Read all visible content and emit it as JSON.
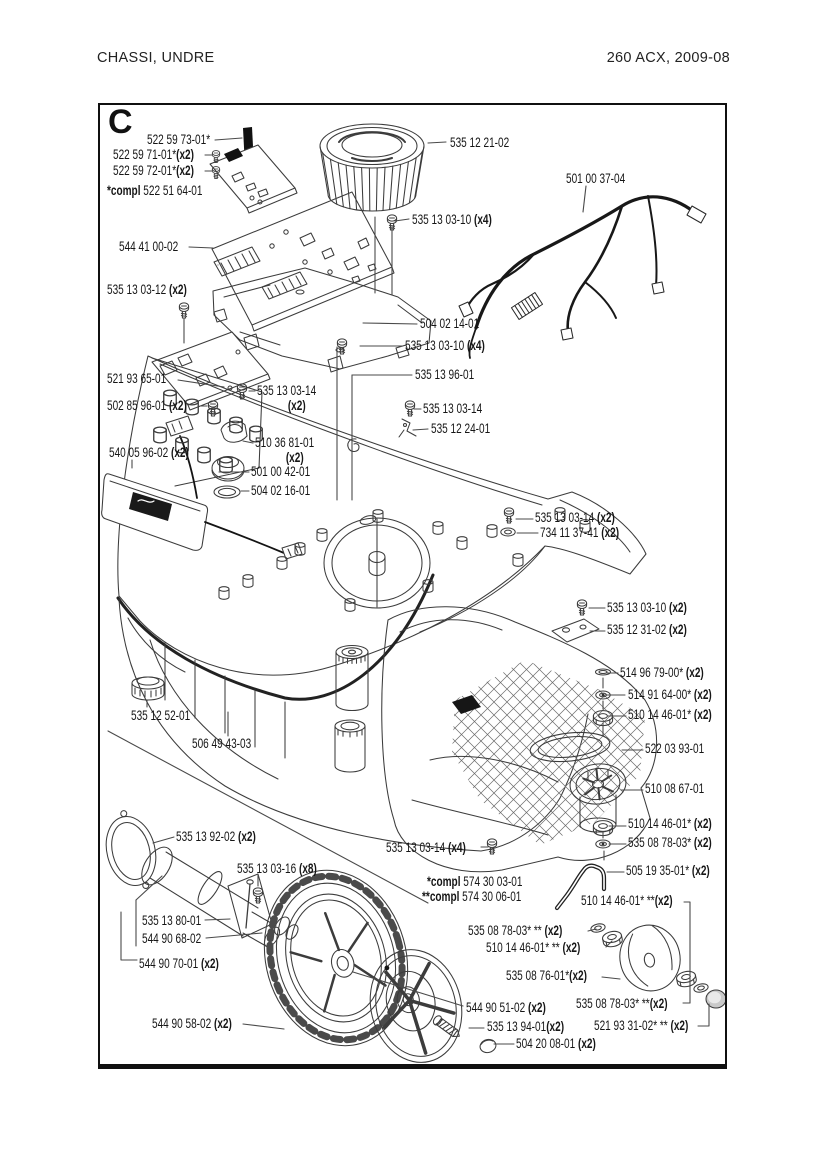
{
  "page": {
    "header_left": "CHASSI,  UNDRE",
    "header_right": "260 ACX, 2009-08",
    "section_letter": "C"
  },
  "diagram": {
    "labels": [
      {
        "num": "522 59 73-01*",
        "x": 147,
        "y": 133
      },
      {
        "num": "522 59 71-01*",
        "qty": "(x2)",
        "x": 113,
        "y": 148
      },
      {
        "num": "522 59 72-01*",
        "qty": "(x2)",
        "x": 113,
        "y": 164
      },
      {
        "pre": "*compl ",
        "num": "522 51 64-01",
        "x": 107,
        "y": 184
      },
      {
        "num": "544 41 00-02",
        "x": 119,
        "y": 240
      },
      {
        "num": "535 12 21-02",
        "x": 450,
        "y": 136
      },
      {
        "num": "501 00 37-04",
        "x": 566,
        "y": 172
      },
      {
        "num": "535 13 03-10 ",
        "qty": "(x4)",
        "x": 412,
        "y": 213
      },
      {
        "num": "535 13 03-12 ",
        "qty": "(x2)",
        "x": 107,
        "y": 283
      },
      {
        "num": "504 02 14-01",
        "x": 420,
        "y": 317
      },
      {
        "num": "535 13 03-10 ",
        "qty": "(x4)",
        "x": 405,
        "y": 339
      },
      {
        "num": "521 93 65-01",
        "x": 107,
        "y": 372
      },
      {
        "num": "535 13 03-14",
        "qty2": "(x2)",
        "x": 257,
        "y": 384
      },
      {
        "num": "502 85 96-01 ",
        "qty": "(x2)",
        "x": 107,
        "y": 399
      },
      {
        "num": "535 13 96-01",
        "x": 415,
        "y": 368
      },
      {
        "num": "535 13 03-14",
        "x": 423,
        "y": 402
      },
      {
        "num": "535 12 24-01",
        "x": 431,
        "y": 422
      },
      {
        "num": "540 05 96-02 ",
        "qty": "(x2)",
        "x": 109,
        "y": 446
      },
      {
        "num": "510 36 81-01",
        "qty2": "(x2)",
        "x": 255,
        "y": 436
      },
      {
        "num": "501 00 42-01",
        "x": 251,
        "y": 465
      },
      {
        "num": "504 02 16-01",
        "x": 251,
        "y": 484
      },
      {
        "num": "535 13 03-14 ",
        "qty": "(x2)",
        "x": 535,
        "y": 511
      },
      {
        "num": "734 11 37-41 ",
        "qty": "(x2)",
        "x": 540,
        "y": 526
      },
      {
        "num": "535 13 03-10 ",
        "qty": "(x2)",
        "x": 607,
        "y": 601
      },
      {
        "num": "535 12 31-02 ",
        "qty": "(x2)",
        "x": 607,
        "y": 623
      },
      {
        "num": "514 96 79-00* ",
        "qty": "(x2)",
        "x": 620,
        "y": 666
      },
      {
        "num": "514 91 64-00* ",
        "qty": "(x2)",
        "x": 628,
        "y": 688
      },
      {
        "num": "510 14 46-01* ",
        "qty": "(x2)",
        "x": 628,
        "y": 708
      },
      {
        "num": "522 03 93-01",
        "x": 645,
        "y": 742
      },
      {
        "num": "510 08 67-01",
        "x": 645,
        "y": 782
      },
      {
        "num": "510 14 46-01* ",
        "qty": "(x2)",
        "x": 628,
        "y": 817
      },
      {
        "num": "535 08 78-03* ",
        "qty": "(x2)",
        "x": 628,
        "y": 836
      },
      {
        "num": "535 12 52-01",
        "x": 131,
        "y": 709
      },
      {
        "num": "506 49 43-03",
        "x": 192,
        "y": 737
      },
      {
        "num": "535 13 92-02 ",
        "qty": "(x2)",
        "x": 176,
        "y": 830
      },
      {
        "num": "535 13 03-14 ",
        "qty": "(x4)",
        "x": 386,
        "y": 841
      },
      {
        "pre": "*compl ",
        "num": "574 30 03-01",
        "x": 427,
        "y": 875
      },
      {
        "pre": "**compl ",
        "num": "574 30 06-01",
        "x": 422,
        "y": 890
      },
      {
        "num": "505 19 35-01* ",
        "qty": "(x2)",
        "x": 626,
        "y": 864
      },
      {
        "num": "535 13 03-16 ",
        "qty": "(x8)",
        "x": 237,
        "y": 862
      },
      {
        "num": "510 14 46-01* **",
        "qty": "(x2)",
        "x": 581,
        "y": 894
      },
      {
        "num": "535 08 78-03* ** ",
        "qty": "(x2)",
        "x": 468,
        "y": 924
      },
      {
        "num": "510 14 46-01* ** ",
        "qty": "(x2)",
        "x": 486,
        "y": 941
      },
      {
        "num": "535 13 80-01",
        "x": 142,
        "y": 914
      },
      {
        "num": "544 90 68-02",
        "x": 142,
        "y": 932
      },
      {
        "num": "544 90 70-01 ",
        "qty": "(x2)",
        "x": 139,
        "y": 957
      },
      {
        "num": "535 08 76-01*",
        "qty": "(x2)",
        "x": 506,
        "y": 969
      },
      {
        "num": "544 90 58-02 ",
        "qty": "(x2)",
        "x": 152,
        "y": 1017
      },
      {
        "num": "544 90 51-02 ",
        "qty": "(x2)",
        "x": 466,
        "y": 1001
      },
      {
        "num": "535 08 78-03* **",
        "qty": "(x2)",
        "x": 576,
        "y": 997
      },
      {
        "num": "535 13 94-01",
        "qty": "(x2)",
        "x": 487,
        "y": 1020
      },
      {
        "num": "521 93 31-02* ** ",
        "qty": "(x2)",
        "x": 594,
        "y": 1019
      },
      {
        "num": "504 20 08-01 ",
        "qty": "(x2)",
        "x": 516,
        "y": 1037
      }
    ],
    "leaders": [
      [
        [
          215,
          140
        ],
        [
          242,
          138
        ]
      ],
      [
        [
          205,
          155
        ],
        [
          212,
          155
        ]
      ],
      [
        [
          205,
          171
        ],
        [
          212,
          171
        ]
      ],
      [
        [
          189,
          247
        ],
        [
          213,
          248
        ]
      ],
      [
        [
          428,
          143
        ],
        [
          446,
          142
        ]
      ],
      [
        [
          586,
          186
        ],
        [
          583,
          212
        ]
      ],
      [
        [
          395,
          221
        ],
        [
          409,
          219
        ]
      ],
      [
        [
          184,
          318
        ],
        [
          184,
          343
        ]
      ],
      [
        [
          363,
          323
        ],
        [
          417,
          324
        ]
      ],
      [
        [
          360,
          346
        ],
        [
          402,
          346
        ]
      ],
      [
        [
          337,
          347
        ],
        [
          337,
          500
        ]
      ],
      [
        [
          178,
          380
        ],
        [
          224,
          387
        ]
      ],
      [
        [
          249,
          391
        ],
        [
          255,
          391
        ]
      ],
      [
        [
          200,
          406
        ],
        [
          207,
          406
        ]
      ],
      [
        [
          412,
          375
        ],
        [
          352,
          375
        ]
      ],
      [
        [
          352,
          375
        ],
        [
          352,
          500
        ]
      ],
      [
        [
          414,
          409
        ],
        [
          421,
          409
        ]
      ],
      [
        [
          413,
          430
        ],
        [
          428,
          429
        ]
      ],
      [
        [
          132,
          460
        ],
        [
          132,
          468
        ]
      ],
      [
        [
          253,
          443
        ],
        [
          243,
          441
        ]
      ],
      [
        [
          219,
          472
        ],
        [
          249,
          472
        ]
      ],
      [
        [
          241,
          491
        ],
        [
          249,
          491
        ]
      ],
      [
        [
          516,
          519
        ],
        [
          533,
          519
        ]
      ],
      [
        [
          517,
          533
        ],
        [
          538,
          533
        ]
      ],
      [
        [
          589,
          608
        ],
        [
          605,
          608
        ]
      ],
      [
        [
          590,
          631
        ],
        [
          605,
          631
        ]
      ],
      [
        [
          607,
          673
        ],
        [
          618,
          673
        ]
      ],
      [
        [
          607,
          695
        ],
        [
          625,
          695
        ]
      ],
      [
        [
          608,
          716
        ],
        [
          626,
          716
        ]
      ],
      [
        [
          622,
          750
        ],
        [
          643,
          750
        ]
      ],
      [
        [
          621,
          790
        ],
        [
          643,
          790
        ]
      ],
      [
        [
          609,
          826
        ],
        [
          626,
          826
        ]
      ],
      [
        [
          609,
          844
        ],
        [
          626,
          844
        ]
      ],
      [
        [
          147,
          700
        ],
        [
          147,
          707
        ]
      ],
      [
        [
          228,
          712
        ],
        [
          228,
          736
        ]
      ],
      [
        [
          174,
          837
        ],
        [
          153,
          843
        ]
      ],
      [
        [
          481,
          847
        ],
        [
          488,
          847
        ]
      ],
      [
        [
          607,
          872
        ],
        [
          624,
          872
        ]
      ],
      [
        [
          684,
          902
        ],
        [
          690,
          902
        ],
        [
          690,
          1003
        ]
      ],
      [
        [
          588,
          931
        ],
        [
          596,
          929
        ]
      ],
      [
        [
          606,
          947
        ],
        [
          612,
          941
        ]
      ],
      [
        [
          205,
          920
        ],
        [
          230,
          919
        ]
      ],
      [
        [
          206,
          938
        ],
        [
          262,
          933
        ]
      ],
      [
        [
          136,
          900
        ],
        [
          136,
          946
        ]
      ],
      [
        [
          121,
          912
        ],
        [
          121,
          960
        ],
        [
          137,
          960
        ]
      ],
      [
        [
          136,
          900
        ],
        [
          162,
          876
        ]
      ],
      [
        [
          602,
          977
        ],
        [
          620,
          979
        ]
      ],
      [
        [
          243,
          1024
        ],
        [
          284,
          1029
        ]
      ],
      [
        [
          353,
          972
        ],
        [
          463,
          1006
        ]
      ],
      [
        [
          683,
          1003
        ],
        [
          690,
          1003
        ]
      ],
      [
        [
          469,
          1028
        ],
        [
          484,
          1028
        ]
      ],
      [
        [
          698,
          1026
        ],
        [
          709,
          1026
        ],
        [
          709,
          1004
        ]
      ],
      [
        [
          494,
          1044
        ],
        [
          514,
          1044
        ]
      ],
      [
        [
          392,
          227
        ],
        [
          392,
          295
        ]
      ],
      [
        [
          375,
          217
        ],
        [
          375,
          293
        ]
      ],
      [
        [
          108,
          731
        ],
        [
          428,
          903
        ]
      ],
      [
        [
          258,
          875
        ],
        [
          258,
          886
        ]
      ],
      [
        [
          603,
          678
        ],
        [
          603,
          688
        ]
      ],
      [
        [
          603,
          701
        ],
        [
          603,
          709
        ]
      ],
      [
        [
          603,
          723
        ],
        [
          603,
          736
        ]
      ],
      [
        [
          603,
          832
        ],
        [
          603,
          838
        ]
      ],
      [
        [
          604,
          851
        ],
        [
          604,
          860
        ]
      ]
    ]
  }
}
